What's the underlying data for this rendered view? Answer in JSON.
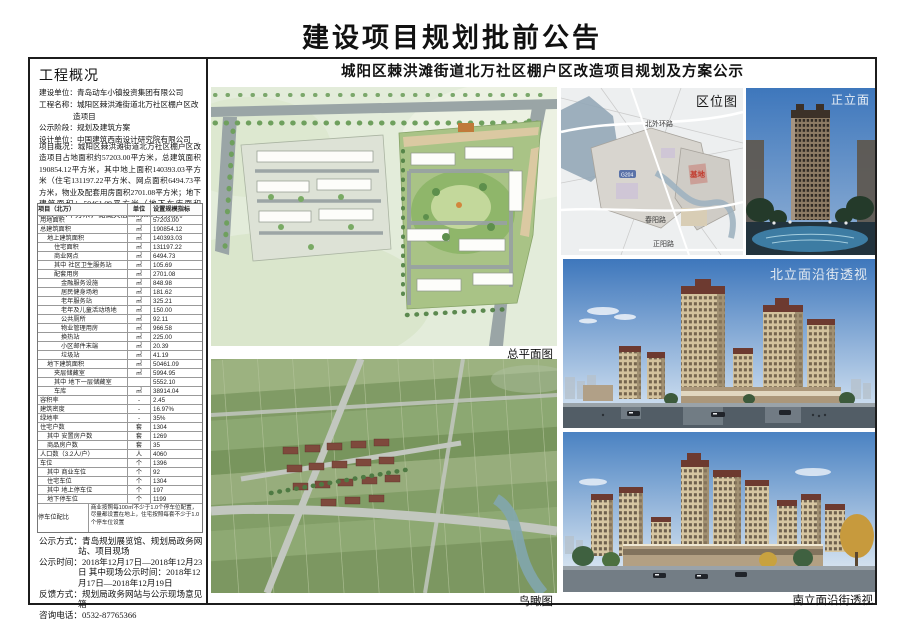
{
  "page": {
    "title": "建设项目规划批前公告"
  },
  "overview": {
    "heading": "工程概况",
    "info_lines": [
      {
        "label": "建设单位：",
        "value": "青岛动车小镇投资集团有限公司"
      },
      {
        "label": "工程名称：",
        "value": "城阳区棘洪滩街道北万社区棚户区改造项目"
      },
      {
        "label": "公示阶段：",
        "value": "规划及建筑方案"
      },
      {
        "label": "设计单位：",
        "value": "中国建筑西南设计研究院有限公司"
      }
    ],
    "project_desc": "项目概况：城阳区棘洪滩街道北万社区棚户区改造项目占地面积约57203.00平方米，总建筑面积190854.12平方米，其中地上面积140393.03平方米（住宅131197.22平方米、网点面积6494.73平方米，物业及配套用房面积2701.08平方米；地下建筑面积：50461.09平方米（地下车库面积38914.04平方米，储藏夹层5994.95平方米）。"
  },
  "table": {
    "headers": [
      "项目（北万）",
      "单位",
      "设置规模指标"
    ],
    "rows": [
      {
        "label": "用地面积",
        "unit": "㎡",
        "value": "57203.00",
        "indent": 0
      },
      {
        "label": "总建筑面积",
        "unit": "㎡",
        "value": "190854.12",
        "indent": 0
      },
      {
        "label": "地上建筑面积",
        "unit": "㎡",
        "value": "140393.03",
        "indent": 1
      },
      {
        "label": "住宅面积",
        "unit": "㎡",
        "value": "131197.22",
        "indent": 2
      },
      {
        "label": "商业网点",
        "unit": "㎡",
        "value": "6494.73",
        "indent": 2
      },
      {
        "label": "社区卫生服务站",
        "unit": "㎡",
        "value": "105.69",
        "indent": 2,
        "qz": true
      },
      {
        "label": "配套用房",
        "unit": "㎡",
        "value": "2701.08",
        "indent": 2
      },
      {
        "label": "金融服务设施",
        "unit": "㎡",
        "value": "848.98",
        "indent": 3
      },
      {
        "label": "居民健身场地",
        "unit": "㎡",
        "value": "181.62",
        "indent": 3
      },
      {
        "label": "老年服务站",
        "unit": "㎡",
        "value": "325.21",
        "indent": 3
      },
      {
        "label": "老年及儿童活动场地",
        "unit": "㎡",
        "value": "150.00",
        "indent": 3
      },
      {
        "label": "公共厕所",
        "unit": "㎡",
        "value": "92.11",
        "indent": 3
      },
      {
        "label": "物业管理用房",
        "unit": "㎡",
        "value": "966.58",
        "indent": 3
      },
      {
        "label": "换热站",
        "unit": "㎡",
        "value": "225.00",
        "indent": 3
      },
      {
        "label": "小区邮件末端",
        "unit": "㎡",
        "value": "20.39",
        "indent": 3
      },
      {
        "label": "垃圾站",
        "unit": "㎡",
        "value": "41.19",
        "indent": 3
      },
      {
        "label": "地下建筑面积",
        "unit": "㎡",
        "value": "50461.09",
        "indent": 1
      },
      {
        "label": "夹层储藏室",
        "unit": "㎡",
        "value": "5994.95",
        "indent": 2
      },
      {
        "label": "地下一层储藏室",
        "unit": "",
        "value": "5552.10",
        "indent": 2,
        "qz": true
      },
      {
        "label": "车库",
        "unit": "㎡",
        "value": "38914.04",
        "indent": 2
      },
      {
        "label": "容积率",
        "unit": "-",
        "value": "2.45",
        "indent": 0
      },
      {
        "label": "建筑密度",
        "unit": "-",
        "value": "16.97%",
        "indent": 0
      },
      {
        "label": "绿地率",
        "unit": "-",
        "value": "35%",
        "indent": 0
      },
      {
        "label": "住宅户数",
        "unit": "套",
        "value": "1304",
        "indent": 0
      },
      {
        "label": "安置房户数",
        "unit": "套",
        "value": "1269",
        "indent": 1,
        "qz": true
      },
      {
        "label": "商品房户数",
        "unit": "套",
        "value": "35",
        "indent": 1
      },
      {
        "label": "人口数（3.2人/户）",
        "unit": "人",
        "value": "4060",
        "indent": 0
      },
      {
        "label": "车位",
        "unit": "个",
        "value": "1396",
        "indent": 0
      },
      {
        "label": "商业车位",
        "unit": "个",
        "value": "92",
        "indent": 1,
        "qz": true
      },
      {
        "label": "住宅车位",
        "unit": "个",
        "value": "1304",
        "indent": 1
      },
      {
        "label": "地上停车位",
        "unit": "个",
        "value": "197",
        "indent": 1,
        "qz": true
      },
      {
        "label": "地下停车位",
        "unit": "个",
        "value": "1199",
        "indent": 1
      }
    ],
    "note_row": {
      "label": "停车位配比",
      "text": "商业按照每100㎡不少于1.0个停车位配置，尽量都设置在地上，住宅按照每套不少于1.0个停车位设置"
    }
  },
  "announcement": {
    "lines": [
      {
        "label": "公示方式：",
        "value": "青岛规划展览馆、规划局政务网站、项目现场"
      },
      {
        "label": "公示时间：",
        "value": "2018年12月17日—2018年12月23日 其中现场公示时间：2018年12月17日—2018年12月19日"
      },
      {
        "label": "反馈方式：",
        "value": "规划局政务网站与公示现场意见箱"
      },
      {
        "label": "咨询电话：",
        "value": "0532-87765366"
      }
    ]
  },
  "main": {
    "subtitle": "城阳区棘洪滩街道北万社区棚户区改造项目规划及方案公示",
    "labels": {
      "site_plan": "总平面图",
      "aerial": "鸟瞰图",
      "location": "区位图",
      "front": "正立面",
      "north": "北立面沿街透视",
      "south": "南立面沿街透视"
    },
    "location_map": {
      "road_top": "北外环路",
      "road_mid": "春阳路",
      "road_bottom": "正阳路",
      "highway_badge": "G204",
      "site_marker": "基地"
    }
  },
  "colors": {
    "accent_red": "#c23b2e",
    "sky_blue": "#3e77bc",
    "plan_green": "#a9c386",
    "field_green": "#93aa78"
  }
}
